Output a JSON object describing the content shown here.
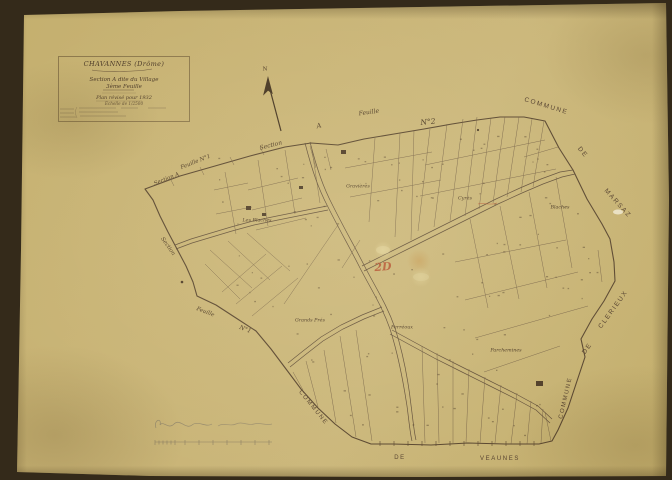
{
  "colors": {
    "paper": "#c8b374",
    "ink": "#5a4630",
    "red_ink": "#b5502f",
    "pencil": "#968a6c"
  },
  "title_block": {
    "commune": "CHAVANNES (Drôme)",
    "section": "Section A dite du Village",
    "sheet": "3ème Feuille",
    "revision": "Plan révisé pour 1932",
    "scale": "Échelle de 1/2500"
  },
  "north_arrow": {
    "label": "N"
  },
  "adjacent_sheet_top": {
    "section": "Section",
    "a": "A",
    "feuille": "Feuille",
    "number": "N°2"
  },
  "adjacent_sheet_nw": {
    "section_a": "Section A",
    "feuille": "Feuille N°1"
  },
  "adjacent_sheet_west": {
    "section": "Section"
  },
  "adjacent_sheet_sw": {
    "feuille": "Feuille",
    "number": "N°1"
  },
  "neighbor_communes": {
    "marsaz": [
      "COMMUNE",
      "DE",
      "MARSAZ"
    ],
    "clerieux": [
      "COMMUNE",
      "DE",
      "CLERIEUX"
    ],
    "veaunes": [
      "COMMUNE",
      "DE",
      "VEAUNES"
    ]
  },
  "lieux_dits": [
    "Les Blaches",
    "Gravières",
    "Cyrès",
    "Blaches",
    "Grands Prés",
    "Ferréoux",
    "Parchemines"
  ],
  "annotations": {
    "red_mark": "2D"
  }
}
